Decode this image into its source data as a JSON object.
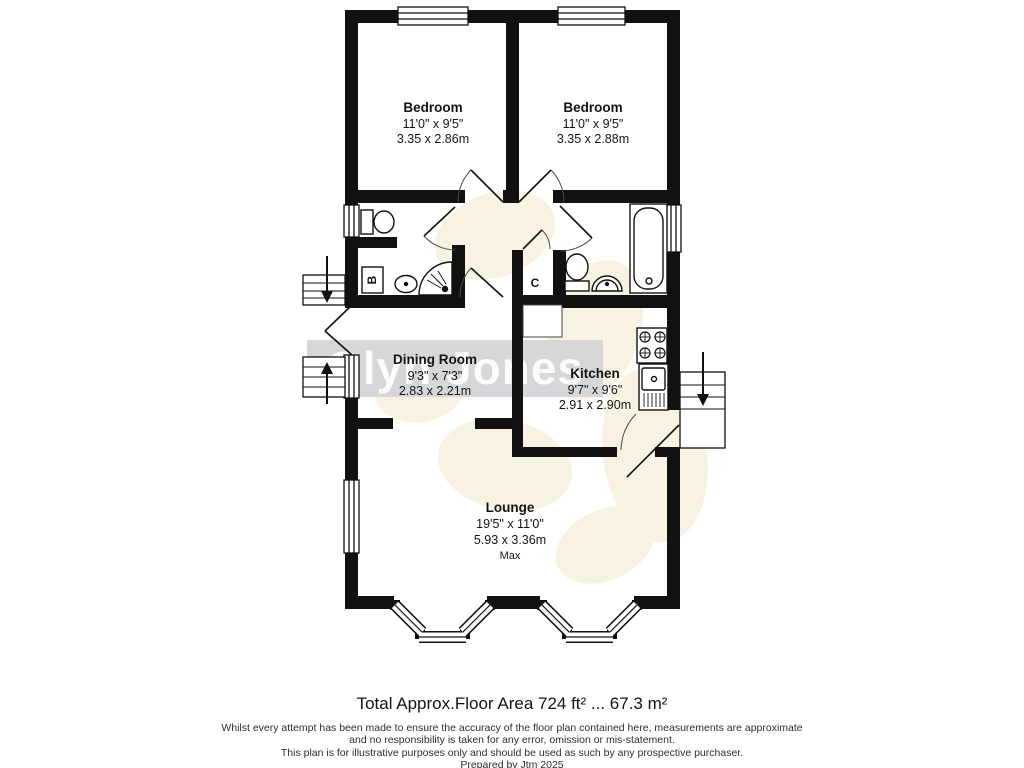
{
  "watermark": {
    "text": "Glyn Jones",
    "band_color": "#d2d2d6",
    "text_color": "#ffffff",
    "flower_color": "#f4e8cb"
  },
  "plan": {
    "wall_color": "#111111",
    "rooms": [
      {
        "id": "bedroom-1",
        "name": "Bedroom",
        "imperial": "11'0\" x 9'5\"",
        "metric": "3.35 x 2.86m"
      },
      {
        "id": "bedroom-2",
        "name": "Bedroom",
        "imperial": "11'0\" x 9'5\"",
        "metric": "3.35 x 2.88m"
      },
      {
        "id": "dining-room",
        "name": "Dining Room",
        "imperial": "9'3\" x 7'3\"",
        "metric": "2.83 x 2.21m"
      },
      {
        "id": "kitchen",
        "name": "Kitchen",
        "imperial": "9'7\" x 9'6\"",
        "metric": "2.91 x 2.90m"
      },
      {
        "id": "lounge",
        "name": "Lounge",
        "imperial": "19'5\" x 11'0\"",
        "metric": "5.93 x 3.36m",
        "note": "Max"
      }
    ],
    "markers": {
      "boiler": "B",
      "cupboard": "C"
    }
  },
  "footer": {
    "total_area": "Total Approx.Floor Area 724 ft² ... 67.3 m²",
    "disclaimer_line1": "Whilst every attempt has been made to ensure the accuracy of the floor plan contained here, measurements are approximate",
    "disclaimer_line2": "and no responsibility is taken for any error, omission or mis-statement.",
    "disclaimer_line3": "This plan is for illustrative purposes only and should be used as such by any prospective purchaser.",
    "prepared_by": "Prepared by Jtm 2025"
  }
}
